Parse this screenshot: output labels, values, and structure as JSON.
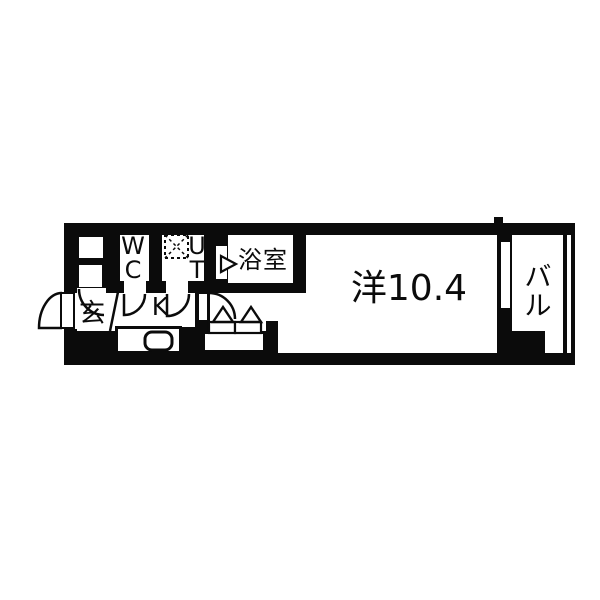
{
  "floorplan": {
    "title": "1K apartment floor plan",
    "colors": {
      "wall": "#0b0b0b",
      "background": "#ffffff"
    },
    "rooms": {
      "entrance": {
        "label": "玄"
      },
      "toilet": {
        "label_line1": "W",
        "label_line2": "C"
      },
      "utility": {
        "label_line1": "U",
        "label_line2": "T"
      },
      "bathroom": {
        "label": "浴室"
      },
      "kitchen": {
        "label": "K"
      },
      "main_room": {
        "label": "洋10.4"
      },
      "balcony": {
        "label_line1": "バ",
        "label_line2": "ル"
      }
    }
  }
}
